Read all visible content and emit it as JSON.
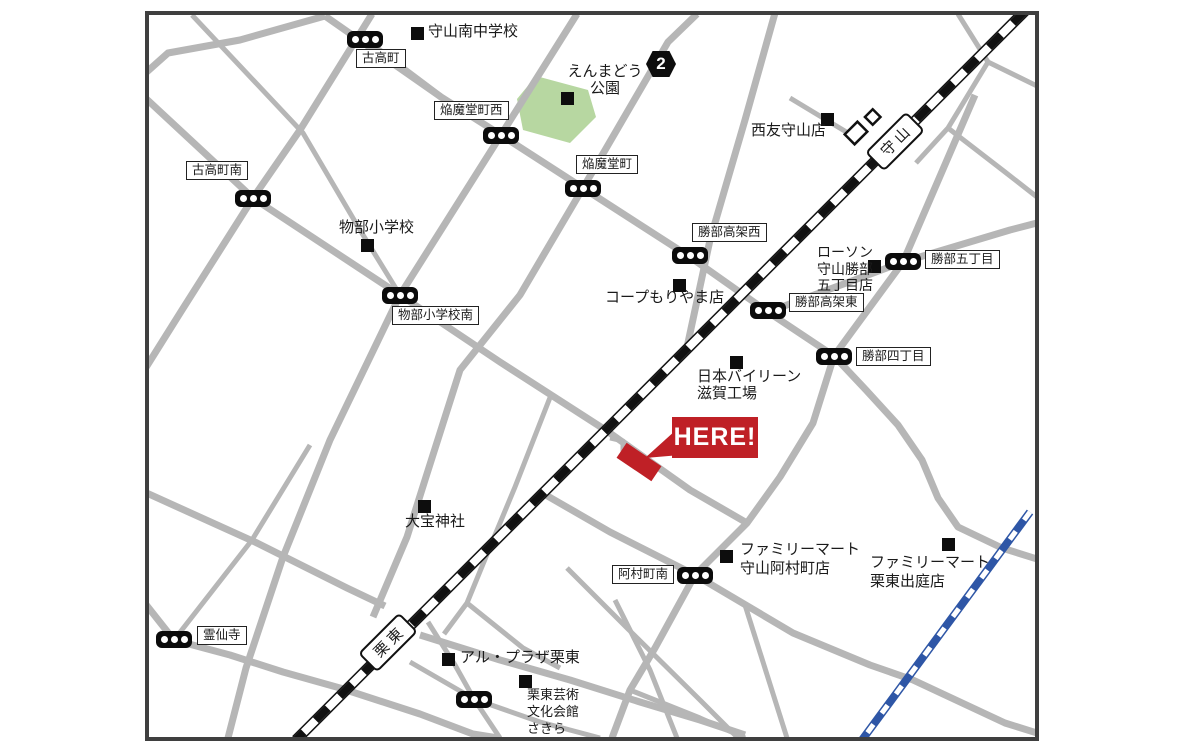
{
  "map": {
    "theme": {
      "frame": "#3f3f3f",
      "road": "#b6b6b6",
      "park": "#b7d7a1",
      "red": "#bf2026",
      "blue": "#2e56a6",
      "signal": "#0b0b0b"
    },
    "here": {
      "label": "HERE!"
    },
    "route_badge": {
      "number": "2"
    },
    "stations": [
      {
        "name": "守山"
      },
      {
        "name": "栗東"
      }
    ],
    "intersections": [
      {
        "label": "古高町"
      },
      {
        "label": "焔魔堂町西"
      },
      {
        "label": "古高町南"
      },
      {
        "label": "焔魔堂町"
      },
      {
        "label": "物部小学校南"
      },
      {
        "label": "勝部高架西"
      },
      {
        "label": "勝部五丁目"
      },
      {
        "label": "勝部高架東"
      },
      {
        "label": "勝部四丁目"
      },
      {
        "label": "阿村町南"
      },
      {
        "label": "霊仙寺"
      }
    ],
    "places": [
      {
        "label": "守山南中学校"
      },
      {
        "label": "えんまどう\n公園"
      },
      {
        "label": "西友守山店"
      },
      {
        "label": "物部小学校"
      },
      {
        "label": "コープもりやま店"
      },
      {
        "label": "ローソン\n守山勝部\n五丁目店"
      },
      {
        "label": "日本バイリーン\n滋賀工場"
      },
      {
        "label": "大宝神社"
      },
      {
        "label": "ファミリーマート\n守山阿村町店"
      },
      {
        "label": "ファミリーマート\n栗東出庭店"
      },
      {
        "label": "アル・プラザ栗東"
      },
      {
        "label": "栗東芸術\n文化会館\nさきら"
      }
    ]
  }
}
